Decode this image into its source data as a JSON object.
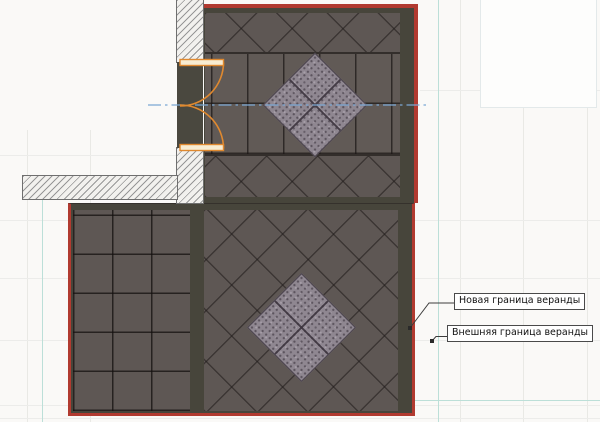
{
  "canvas": {
    "description": "Architectural plan view of a veranda paving layout with hatched walls, double door and boundary annotations"
  },
  "annotations": {
    "new_boundary": {
      "text": "Новая граница веранды"
    },
    "outer_boundary": {
      "text": "Внешняя граница веранды"
    }
  },
  "colors": {
    "boundary_red": "#b13a30",
    "tile_field": "#5e5754",
    "tile_grout": "#3b3534",
    "border_band": "#47453b",
    "inlay_tile": "#8f8791",
    "wall_hatch": "#979797",
    "door_orange": "#e0892f",
    "centerline_blue": "#7ba7d4",
    "guide_teal": "#bcdfd8",
    "grid_gray": "#e9e9e5",
    "background": "#faf9f7"
  }
}
